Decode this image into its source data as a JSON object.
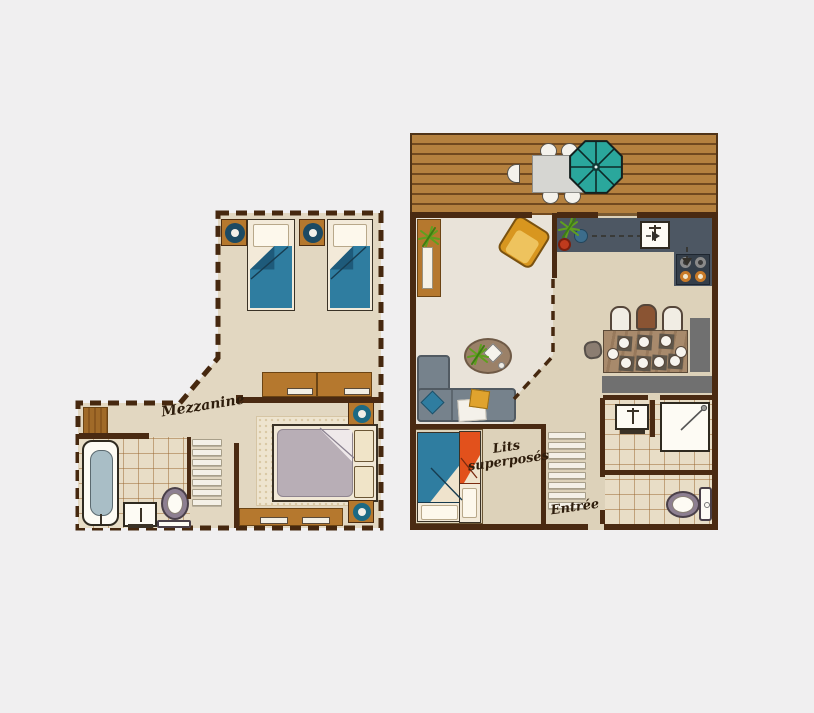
{
  "image_type": "apartment floor plan illustration, two levels side by side",
  "plans": {
    "mezzanine": {
      "label": "Mezzanine",
      "outline": "dashed perimeter (open mezzanine level)",
      "rooms": [
        "twin-bedroom",
        "double-bedroom",
        "bathroom",
        "stair-landing"
      ],
      "furniture": [
        "twin-bed",
        "twin-bed",
        "bedside-table-lamp",
        "bedside-table-lamp",
        "desk",
        "desk",
        "double-bed",
        "bedside-table-lamp",
        "bedside-table-lamp",
        "low-dresser",
        "wardrobe",
        "bathtub",
        "washbasin",
        "toilet",
        "staircase"
      ]
    },
    "ground_floor": {
      "labels": {
        "bunk_line1": "Lits",
        "bunk_line2": "superposés",
        "entrance": "Entrée"
      },
      "rooms": [
        "terrace-deck",
        "living-room",
        "kitchen",
        "dining-area",
        "bunk-bedroom",
        "entrance-hall",
        "shower-room",
        "wc"
      ],
      "furniture": [
        "outdoor-table",
        "outdoor-chairs-5",
        "parasol",
        "plant-shelf",
        "armchair",
        "kitchen-counter",
        "kitchen-sink",
        "cooktop-4-burners",
        "pot",
        "kettle",
        "dining-table-9-settings",
        "dining-chairs",
        "sideboard",
        "bench",
        "corner-sofa",
        "cushions",
        "rug-with-coffee-table",
        "bunk-bed-blue",
        "bunk-bed-orange",
        "staircase",
        "washbasin",
        "shower",
        "toilet"
      ]
    }
  },
  "colors": {
    "bg": "#f0eff0",
    "wall": "#4a2a12",
    "dash": "#46280f",
    "floor_mezz": "#e2d7c1",
    "floor_living": "#e9e3d9",
    "floor_kitchen": "#ddd2ba",
    "tile": "#e8ddc6",
    "deck": "#b5813f",
    "deckline": "#71491f",
    "wood": "#b5782e",
    "blue": "#2f7da0",
    "blue_dark": "#1e5a7a",
    "orange": "#e2511c",
    "teal": "#2aa79c",
    "sofa": "#76828c",
    "counter": "#4d5763",
    "stove": "#343e49",
    "yellow": "#d8961f",
    "duvet_gray": "#b8aeb6",
    "lamp_navy": "#1c4a63",
    "lamp_teal": "#1d6a84",
    "gray_furniture": "#707070"
  }
}
